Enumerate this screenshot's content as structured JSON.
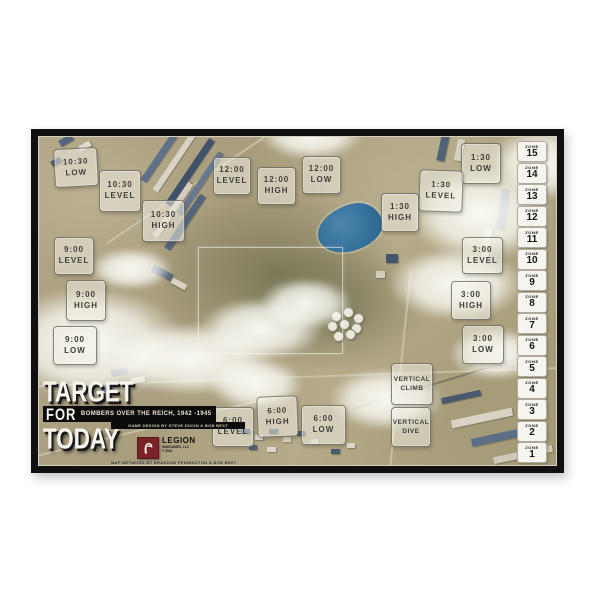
{
  "board": {
    "title_line1": "TARGET",
    "title_line2": "FOR",
    "title_line3": "TODAY",
    "subtitle": "BOMBERS OVER THE REICH, 1942 -1945",
    "design_credit": "GAME DESIGN BY STEVE DIXON & BOB BEST",
    "art_credit": "MAP ARTWORK BY BRANDON PENNINGTON & BOB BEST",
    "publisher": {
      "name": "LEGION",
      "sub": "WARGAMES, LLC",
      "year": "© 2016",
      "logo_icon": "spartan-helmet-icon",
      "brand_color": "#7a2226"
    }
  },
  "colors": {
    "frame": "#101010",
    "terrain_tan": "#ab9f80",
    "building_blue": "#4c5e76",
    "lake_blue": "#35719b",
    "box_fill": "rgba(242,240,231,0.52)",
    "zone_fill": "#f6f4ee"
  },
  "position_boxes": [
    {
      "id": "10-30-low",
      "line1": "10:30",
      "line2": "LOW",
      "x": 23,
      "y": 19,
      "w": 42,
      "h": 37,
      "rot": -3
    },
    {
      "id": "10-30-level",
      "line1": "10:30",
      "line2": "LEVEL",
      "x": 68,
      "y": 41,
      "w": 40,
      "h": 40,
      "rot": 0
    },
    {
      "id": "10-30-high",
      "line1": "10:30",
      "line2": "HIGH",
      "x": 111,
      "y": 71,
      "w": 41,
      "h": 40,
      "rot": 0
    },
    {
      "id": "12-00-level",
      "line1": "12:00",
      "line2": "LEVEL",
      "x": 182,
      "y": 28,
      "w": 36,
      "h": 36,
      "rot": 0
    },
    {
      "id": "12-00-high",
      "line1": "12:00",
      "line2": "HIGH",
      "x": 226,
      "y": 38,
      "w": 37,
      "h": 36,
      "rot": 0
    },
    {
      "id": "12-00-low",
      "line1": "12:00",
      "line2": "LOW",
      "x": 271,
      "y": 27,
      "w": 37,
      "h": 36,
      "rot": 0
    },
    {
      "id": "1-30-low",
      "line1": "1:30",
      "line2": "LOW",
      "x": 430,
      "y": 14,
      "w": 38,
      "h": 39,
      "rot": 0
    },
    {
      "id": "1-30-level",
      "line1": "1:30",
      "line2": "LEVEL",
      "x": 388,
      "y": 41,
      "w": 42,
      "h": 40,
      "rot": 2
    },
    {
      "id": "1-30-high",
      "line1": "1:30",
      "line2": "HIGH",
      "x": 350,
      "y": 64,
      "w": 36,
      "h": 37,
      "rot": 0
    },
    {
      "id": "9-00-level",
      "line1": "9:00",
      "line2": "LEVEL",
      "x": 23,
      "y": 108,
      "w": 38,
      "h": 36,
      "rot": 0
    },
    {
      "id": "9-00-high",
      "line1": "9:00",
      "line2": "HIGH",
      "x": 35,
      "y": 151,
      "w": 38,
      "h": 39,
      "rot": 0
    },
    {
      "id": "9-00-low",
      "line1": "9:00",
      "line2": "LOW",
      "x": 22,
      "y": 197,
      "w": 42,
      "h": 37,
      "rot": 0
    },
    {
      "id": "3-00-level",
      "line1": "3:00",
      "line2": "LEVEL",
      "x": 431,
      "y": 108,
      "w": 39,
      "h": 35,
      "rot": 0
    },
    {
      "id": "3-00-high",
      "line1": "3:00",
      "line2": "HIGH",
      "x": 420,
      "y": 152,
      "w": 38,
      "h": 37,
      "rot": 0
    },
    {
      "id": "3-00-low",
      "line1": "3:00",
      "line2": "LOW",
      "x": 431,
      "y": 196,
      "w": 40,
      "h": 37,
      "rot": 0
    },
    {
      "id": "6-00-level",
      "line1": "6:00",
      "line2": "LEVEL",
      "x": 181,
      "y": 278,
      "w": 40,
      "h": 38,
      "rot": 0
    },
    {
      "id": "6-00-high",
      "line1": "6:00",
      "line2": "HIGH",
      "x": 226,
      "y": 267,
      "w": 39,
      "h": 39,
      "rot": -2
    },
    {
      "id": "6-00-low",
      "line1": "6:00",
      "line2": "LOW",
      "x": 270,
      "y": 276,
      "w": 43,
      "h": 38,
      "rot": 0
    },
    {
      "id": "vertical-climb",
      "line1": "VERTICAL",
      "line2": "CLIMB",
      "x": 360,
      "y": 234,
      "w": 40,
      "h": 40,
      "rot": 0
    },
    {
      "id": "vertical-dive",
      "line1": "VERTICAL",
      "line2": "DIVE",
      "x": 360,
      "y": 278,
      "w": 38,
      "h": 38,
      "rot": 0
    }
  ],
  "zone_track": {
    "label": "ZONE",
    "zones": [
      15,
      14,
      13,
      12,
      11,
      10,
      9,
      8,
      7,
      6,
      5,
      4,
      3,
      2,
      1
    ]
  }
}
